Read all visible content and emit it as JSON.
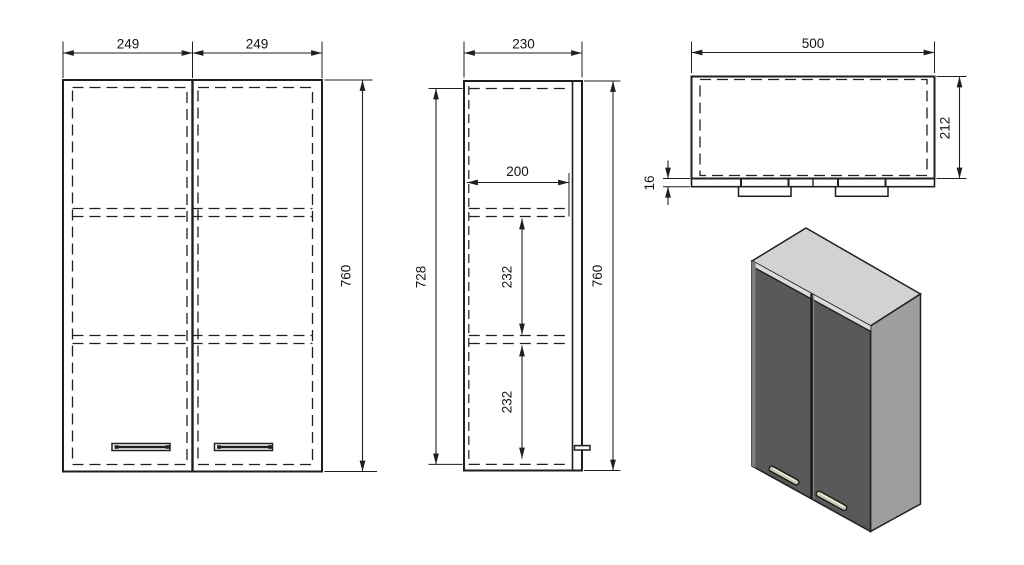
{
  "drawing": {
    "subject": "two-door wall cabinet technical drawing",
    "views": {
      "front": {
        "door_width_left": "249",
        "door_width_right": "249",
        "height": "760"
      },
      "side": {
        "depth": "230",
        "inner_depth": "200",
        "upper_shelf_gap": "232",
        "lower_shelf_gap": "232",
        "inner_height": "728",
        "height": "760"
      },
      "top": {
        "width": "500",
        "depth": "212",
        "door_thickness": "16"
      }
    },
    "colors": {
      "line": "#1f1f1f",
      "iso_top_face": "#d2d2d2",
      "iso_front_face": "#595959",
      "iso_side_face": "#9e9e9e",
      "iso_edge_band": "#dcdcdc",
      "iso_left_edge": "#7d7d7d",
      "iso_divider_highlight": "#8a8a8a",
      "handle_fill": "#c9c9b5"
    }
  }
}
